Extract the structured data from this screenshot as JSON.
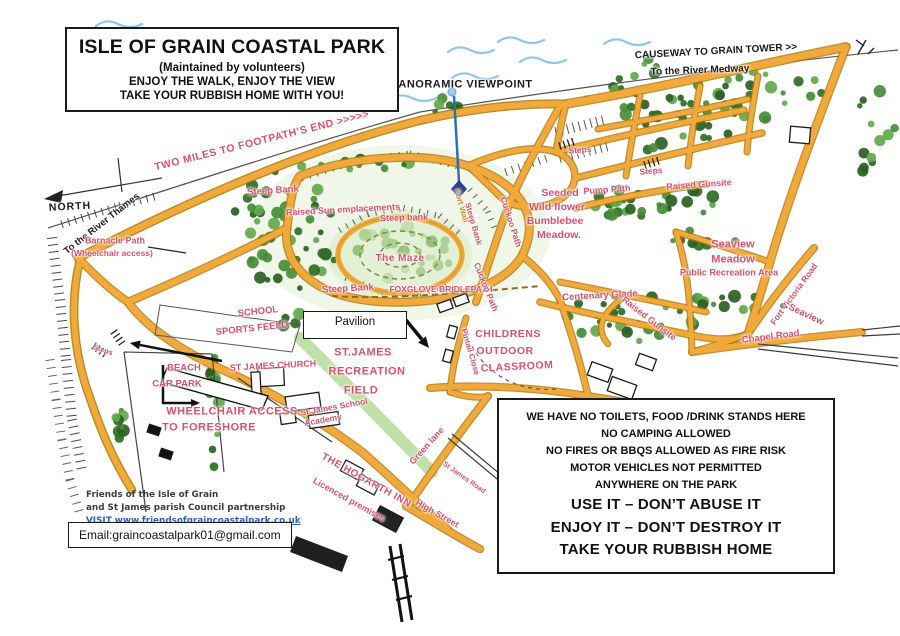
{
  "colors": {
    "label_red": "#d4536b",
    "label_black": "#1b1b1b",
    "label_orange": "#d78a1f",
    "path_orange": "#f2a93b",
    "link_blue": "#2f5fc4"
  },
  "title_box": {
    "line1": "ISLE OF GRAIN COASTAL PARK",
    "line2": "(Maintained by volunteers)",
    "line3": "ENJOY THE WALK, ENJOY THE VIEW",
    "line4": "TAKE YOUR RUBBISH HOME WITH YOU!"
  },
  "pavilion_box": {
    "label": "Pavilion"
  },
  "notice_box": {
    "small_lines": [
      "WE HAVE NO TOILETS, FOOD /DRINK STANDS HERE",
      "NO CAMPING ALLOWED",
      "NO FIRES OR BBQS ALLOWED AS FIRE RISK",
      "MOTOR VEHICLES NOT PERMITTED",
      "ANYWHERE ON THE PARK"
    ],
    "big_lines": [
      "USE IT – DON’T ABUSE IT",
      "ENJOY IT – DON’T DESTROY IT",
      "TAKE YOUR RUBBISH HOME"
    ]
  },
  "credits": {
    "line1": "Friends of the Isle of Grain",
    "line2": "and St James parish Council partnership",
    "visit_line": "VISIT www.friendsofgraincoastalpark.co.uk"
  },
  "email_box": {
    "text": "Email:graincoastalpark01@gmail.com"
  },
  "map_labels": [
    {
      "t": "PANORAMIC  VIEWPOINT",
      "x": 462,
      "y": 85,
      "r": 0,
      "c": "black",
      "fs": 11,
      "fw": 700,
      "ls": 0.5
    },
    {
      "t": "CAUSEWAY TO GRAIN TOWER  >>",
      "x": 716,
      "y": 52,
      "r": -3,
      "c": "black",
      "fs": 10,
      "fw": 700
    },
    {
      "t": "To the River Medway",
      "x": 700,
      "y": 71,
      "r": -2,
      "c": "black",
      "fs": 10,
      "fw": 700
    },
    {
      "t": "TWO MILES TO  FOOTPATH’S END  >>>>>",
      "x": 262,
      "y": 141,
      "r": -14,
      "c": "red",
      "fs": 10.5,
      "fw": 700,
      "ls": 0.5
    },
    {
      "t": "NORTH",
      "x": 70,
      "y": 207,
      "r": -3,
      "c": "black",
      "fs": 10.5,
      "fw": 700,
      "ls": 1
    },
    {
      "t": "To the River Thames",
      "x": 102,
      "y": 224,
      "r": -38,
      "c": "black",
      "fs": 9.5,
      "fw": 700
    },
    {
      "t": "Barnacle Path",
      "x": 115,
      "y": 241,
      "r": 0,
      "c": "red",
      "fs": 9,
      "fw": 700
    },
    {
      "t": "(Wheelchair access)",
      "x": 112,
      "y": 253,
      "r": 0,
      "c": "red",
      "fs": 8.5,
      "fw": 700
    },
    {
      "t": "Steep Bank",
      "x": 273,
      "y": 191,
      "r": -4,
      "c": "red",
      "fs": 9.5,
      "fw": 700
    },
    {
      "t": "Raised Sun emplacements",
      "x": 343,
      "y": 210,
      "r": -3,
      "c": "red",
      "fs": 9,
      "fw": 700
    },
    {
      "t": "Steep bank",
      "x": 404,
      "y": 218,
      "r": -2,
      "c": "red",
      "fs": 9,
      "fw": 700
    },
    {
      "t": "The Maze",
      "x": 400,
      "y": 259,
      "r": 0,
      "c": "red",
      "fs": 10,
      "fw": 700,
      "ls": 0.5
    },
    {
      "t": "Steep Bank",
      "x": 348,
      "y": 289,
      "r": -3,
      "c": "red",
      "fs": 9.5,
      "fw": 700
    },
    {
      "t": "FOXGLOVE BRIDLEPATH",
      "x": 441,
      "y": 289,
      "r": 0,
      "c": "red",
      "fs": 8.5,
      "fw": 700
    },
    {
      "t": "Fort Wall",
      "x": 461,
      "y": 206,
      "r": 74,
      "c": "orange",
      "fs": 8,
      "fw": 700
    },
    {
      "t": "Steep Bank",
      "x": 473,
      "y": 224,
      "r": 74,
      "c": "red",
      "fs": 8,
      "fw": 700
    },
    {
      "t": "Cuckoo Path",
      "x": 511,
      "y": 222,
      "r": 72,
      "c": "red",
      "fs": 8.5,
      "fw": 700
    },
    {
      "t": "Cuckoo Path",
      "x": 486,
      "y": 287,
      "r": 68,
      "c": "red",
      "fs": 8.5,
      "fw": 700
    },
    {
      "t": "Steps",
      "x": 580,
      "y": 150,
      "r": -5,
      "c": "red",
      "fs": 8.5,
      "fw": 700
    },
    {
      "t": "Steps",
      "x": 651,
      "y": 171,
      "r": -5,
      "c": "red",
      "fs": 8.5,
      "fw": 700
    },
    {
      "t": "Pump Path",
      "x": 607,
      "y": 190,
      "r": -4,
      "c": "red",
      "fs": 9,
      "fw": 700
    },
    {
      "t": "Raised Gunsite",
      "x": 699,
      "y": 185,
      "r": -4,
      "c": "red",
      "fs": 9,
      "fw": 700
    },
    {
      "t": "Seeded",
      "x": 560,
      "y": 193,
      "r": 0,
      "c": "red",
      "fs": 10.5,
      "fw": 700
    },
    {
      "t": "Wild flower",
      "x": 557,
      "y": 207,
      "r": 0,
      "c": "red",
      "fs": 10.5,
      "fw": 700
    },
    {
      "t": "Bumblebee",
      "x": 555,
      "y": 221,
      "r": 0,
      "c": "red",
      "fs": 10.5,
      "fw": 700
    },
    {
      "t": "Meadow.",
      "x": 559,
      "y": 235,
      "r": 0,
      "c": "red",
      "fs": 10.5,
      "fw": 700
    },
    {
      "t": "Seaview",
      "x": 733,
      "y": 245,
      "r": 0,
      "c": "red",
      "fs": 11,
      "fw": 700
    },
    {
      "t": "Meadow",
      "x": 733,
      "y": 260,
      "r": 0,
      "c": "red",
      "fs": 11,
      "fw": 700
    },
    {
      "t": "Public Recreation Area",
      "x": 729,
      "y": 273,
      "r": 0,
      "c": "red",
      "fs": 9,
      "fw": 700
    },
    {
      "t": "Fort Victoria Road",
      "x": 794,
      "y": 294,
      "r": -54,
      "c": "red",
      "fs": 8.5,
      "fw": 700
    },
    {
      "t": "Seaview",
      "x": 806,
      "y": 315,
      "r": 25,
      "c": "red",
      "fs": 9.5,
      "fw": 700
    },
    {
      "t": "Chapel Road.",
      "x": 772,
      "y": 337,
      "r": -7,
      "c": "red",
      "fs": 9.5,
      "fw": 700
    },
    {
      "t": "Centenary Glade",
      "x": 600,
      "y": 296,
      "r": -3,
      "c": "red",
      "fs": 9.5,
      "fw": 700
    },
    {
      "t": "Raised Gunsite",
      "x": 649,
      "y": 319,
      "r": 38,
      "c": "red",
      "fs": 9,
      "fw": 700
    },
    {
      "t": "SCHOOL",
      "x": 258,
      "y": 312,
      "r": -6,
      "c": "red",
      "fs": 9.5,
      "fw": 700
    },
    {
      "t": "SPORTS FEELD",
      "x": 252,
      "y": 329,
      "r": -6,
      "c": "red",
      "fs": 9.5,
      "fw": 700
    },
    {
      "t": "ST JAMES CHURCH",
      "x": 273,
      "y": 366,
      "r": -3,
      "c": "red",
      "fs": 9,
      "fw": 700
    },
    {
      "t": "St James School",
      "x": 334,
      "y": 407,
      "r": -10,
      "c": "red",
      "fs": 8.5,
      "fw": 700
    },
    {
      "t": "Academy",
      "x": 323,
      "y": 420,
      "r": -10,
      "c": "red",
      "fs": 8.5,
      "fw": 700
    },
    {
      "t": "ST.JAMES",
      "x": 363,
      "y": 353,
      "r": 0,
      "c": "red",
      "fs": 11,
      "fw": 700,
      "ls": 0.5
    },
    {
      "t": "RECREATION",
      "x": 367,
      "y": 372,
      "r": 0,
      "c": "red",
      "fs": 11,
      "fw": 700,
      "ls": 0.5
    },
    {
      "t": "FIELD",
      "x": 361,
      "y": 391,
      "r": 0,
      "c": "red",
      "fs": 11,
      "fw": 700,
      "ls": 0.5
    },
    {
      "t": "CHILDRENS",
      "x": 508,
      "y": 334,
      "r": 0,
      "c": "red",
      "fs": 10.5,
      "fw": 700,
      "ls": 0.5
    },
    {
      "t": "OUTDOOR",
      "x": 505,
      "y": 351,
      "r": 0,
      "c": "red",
      "fs": 10.5,
      "fw": 700,
      "ls": 0.5
    },
    {
      "t": "CLASSROOM",
      "x": 517,
      "y": 367,
      "r": -3,
      "c": "red",
      "fs": 10.5,
      "fw": 700,
      "ls": 0.5
    },
    {
      "t": "Pintail Close",
      "x": 470,
      "y": 352,
      "r": 74,
      "c": "red",
      "fs": 8,
      "fw": 700
    },
    {
      "t": "BEACH",
      "x": 184,
      "y": 368,
      "r": 0,
      "c": "red",
      "fs": 9.5,
      "fw": 700
    },
    {
      "t": "CAR PARK",
      "x": 177,
      "y": 384,
      "r": 0,
      "c": "red",
      "fs": 9.5,
      "fw": 700
    },
    {
      "t": "Steps",
      "x": 103,
      "y": 350,
      "r": 18,
      "c": "red",
      "fs": 7.5,
      "fw": 700
    },
    {
      "t": "WHEELCHAIR ACCESS",
      "x": 232,
      "y": 412,
      "r": 0,
      "c": "red",
      "fs": 11,
      "fw": 700,
      "ls": 0.5
    },
    {
      "t": "TO FORESHORE",
      "x": 209,
      "y": 428,
      "r": 0,
      "c": "red",
      "fs": 11,
      "fw": 700,
      "ls": 0.5
    },
    {
      "t": "THE HOGARTH INN",
      "x": 366,
      "y": 481,
      "r": 29,
      "c": "red",
      "fs": 10,
      "fw": 700,
      "ls": 0.5
    },
    {
      "t": "Licenced premises",
      "x": 349,
      "y": 500,
      "r": 29,
      "c": "red",
      "fs": 9,
      "fw": 700
    },
    {
      "t": "Green lane",
      "x": 427,
      "y": 446,
      "r": -48,
      "c": "red",
      "fs": 9,
      "fw": 700
    },
    {
      "t": "St James Road",
      "x": 464,
      "y": 478,
      "r": 35,
      "c": "red",
      "fs": 7,
      "fw": 700
    },
    {
      "t": "High Street",
      "x": 437,
      "y": 514,
      "r": 29,
      "c": "red",
      "fs": 9,
      "fw": 700
    }
  ]
}
